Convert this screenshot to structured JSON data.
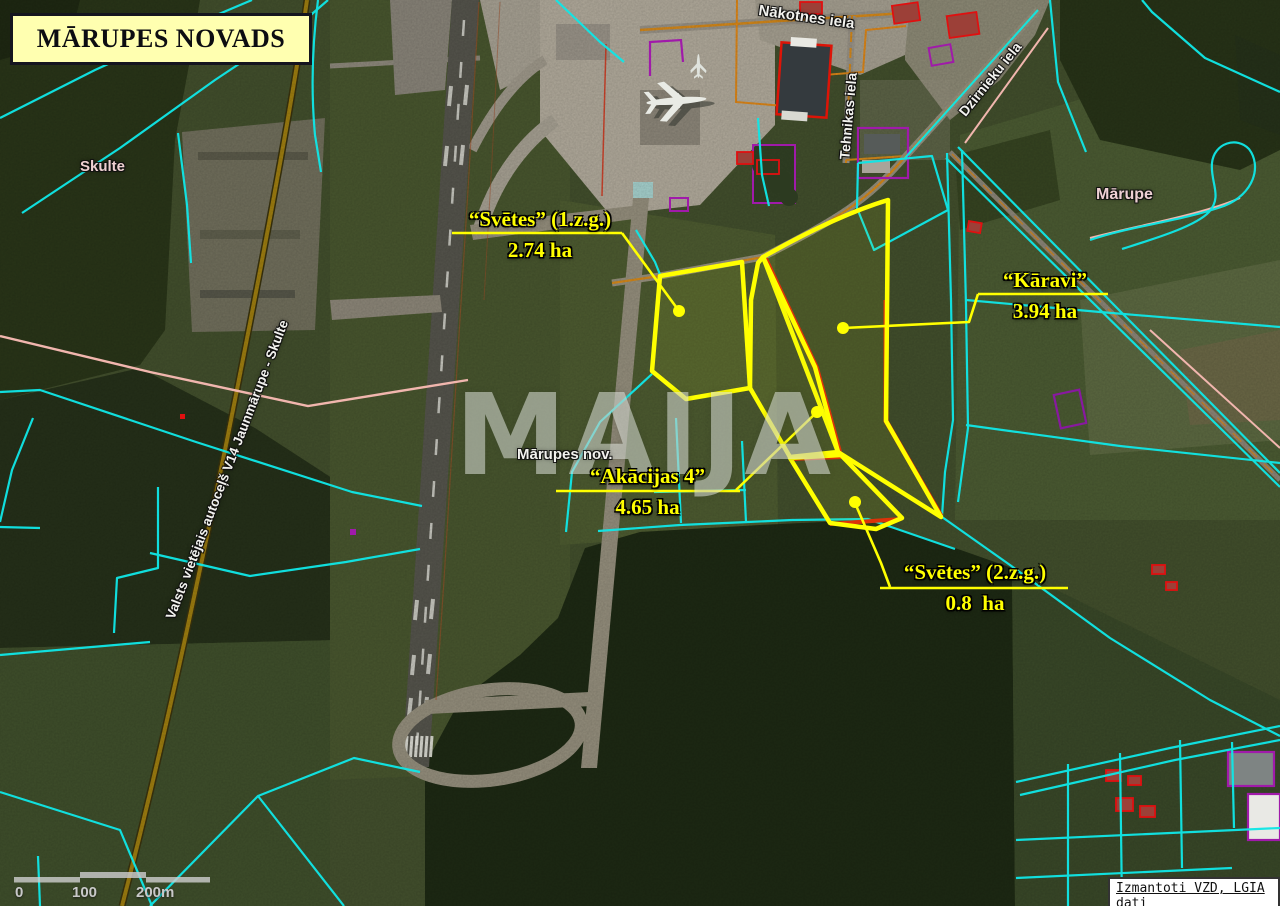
{
  "title": "MĀRUPES NOVADS",
  "watermark": "MAIJA",
  "region_label": "Mārupes nov.",
  "parcels": [
    {
      "name": "“Svētes” (1.z.g.)",
      "area": "2.74 ha"
    },
    {
      "name": "“Kāravi”",
      "area": "3.94 ha"
    },
    {
      "name": "“Akācijas 4”",
      "area": "4.65 ha"
    },
    {
      "name": "“Svētes” (2.z.g.)",
      "area": "0.8  ha"
    }
  ],
  "places": {
    "skulte": "Skulte",
    "marupe": "Mārupe"
  },
  "streets": {
    "nakotnes": "Nākotnes iela",
    "tehnikas": "Tehnikas iela",
    "dzirnieku": "Dzirnieku iela",
    "road_v14": "Valsts vietējais autoceļš V14 Jaunmārupe - Skulte"
  },
  "scale_bar": {
    "start": "0",
    "mid": "100",
    "end": "200m"
  },
  "attribution": "Izmantoti VZD, LGIA dati",
  "colors": {
    "parcel_highlight": "#ffff00",
    "cadastral_line": "#10e6e6",
    "road_line": "#a07f10",
    "title_bg": "#ffffb0"
  }
}
